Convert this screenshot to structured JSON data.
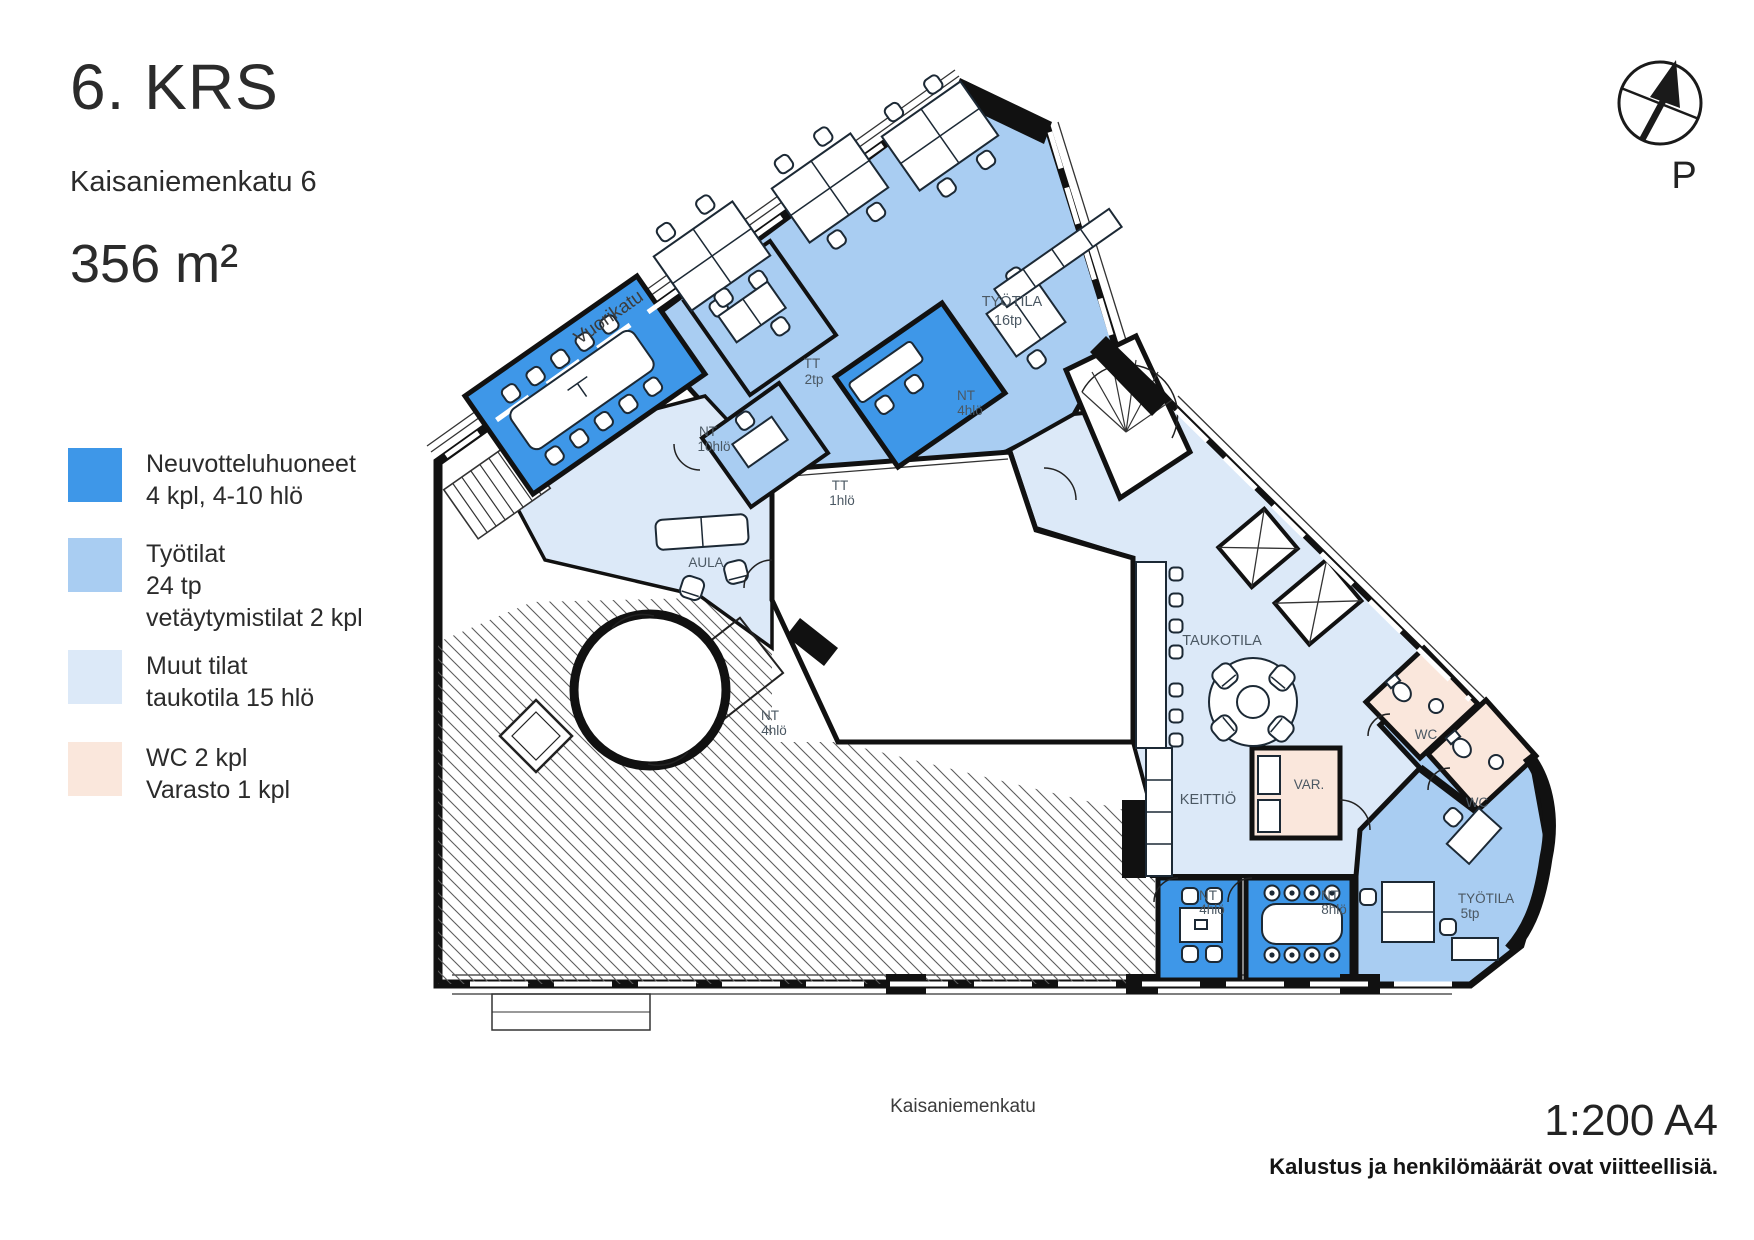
{
  "header": {
    "floor": "6. KRS",
    "address": "Kaisaniemenkatu 6",
    "area": "356 m²"
  },
  "legend": [
    {
      "color": "#3E97E8",
      "label_lines": [
        "Neuvotteluhuoneet",
        "4 kpl, 4-10 hlö"
      ]
    },
    {
      "color": "#A9CDF2",
      "label_lines": [
        "Työtilat",
        "24 tp",
        "vetäytymistilat 2 kpl"
      ]
    },
    {
      "color": "#DCE9F8",
      "label_lines": [
        "Muut tilat",
        "taukotila 15 hlö"
      ]
    },
    {
      "color": "#FAE7DC",
      "label_lines": [
        "WC 2 kpl",
        "Varasto 1 kpl"
      ]
    }
  ],
  "colors": {
    "meeting": "#3E97E8",
    "work": "#A9CDF2",
    "other": "#DCE9F8",
    "wc": "#FAE7DC"
  },
  "compass": {
    "label": "P"
  },
  "streets": {
    "top": "Vuorikatu",
    "bottom": "Kaisaniemenkatu"
  },
  "plan": {
    "rooms": [
      {
        "name": "TYÖTILA",
        "detail": "16tp"
      },
      {
        "name": "TT",
        "detail": "2tp"
      },
      {
        "name": "NT",
        "detail": "4hlö"
      },
      {
        "name": "NT",
        "detail": "10hlö"
      },
      {
        "name": "TT",
        "detail": "1hlö"
      },
      {
        "name": "AULA",
        "detail": ""
      },
      {
        "name": "NT",
        "detail": "4hlö"
      },
      {
        "name": "TAUKOTILA",
        "detail": ""
      },
      {
        "name": "KEITTIÖ",
        "detail": ""
      },
      {
        "name": "VAR.",
        "detail": ""
      },
      {
        "name": "WC",
        "detail": ""
      },
      {
        "name": "WC",
        "detail": ""
      },
      {
        "name": "TYÖTILA",
        "detail": "5tp"
      },
      {
        "name": "NT",
        "detail": "4hlö"
      },
      {
        "name": "NT",
        "detail": "8hlö"
      }
    ]
  },
  "footer": {
    "scale": "1:200 A4",
    "note": "Kalustus ja henkilömäärät ovat viitteellisiä."
  }
}
